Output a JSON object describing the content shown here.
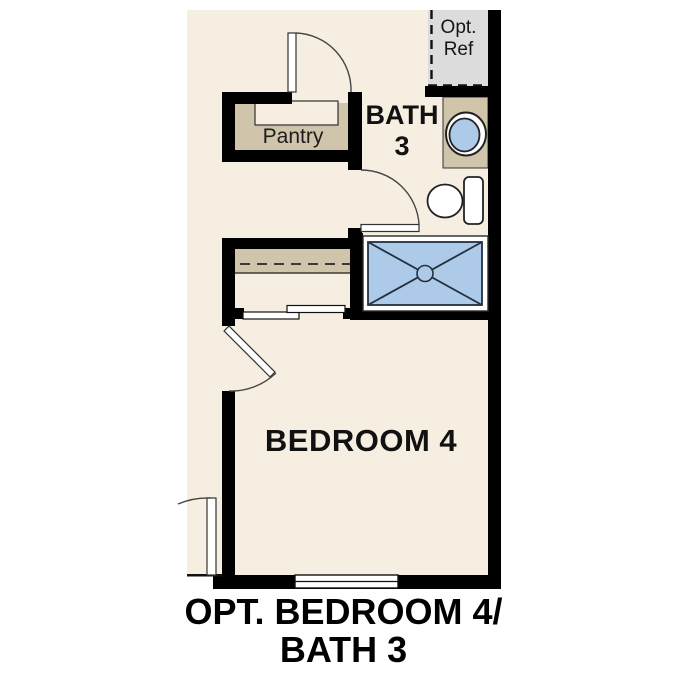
{
  "caption": {
    "line1": "OPT. BEDROOM 4/",
    "line2": "BATH 3"
  },
  "rooms": {
    "pantry": {
      "label": "Pantry"
    },
    "bath": {
      "name_line1": "BATH",
      "name_line2": "3"
    },
    "bedroom": {
      "label": "BEDROOM 4"
    }
  },
  "annotations": {
    "opt_ref": {
      "line1": "Opt.",
      "line2": "Ref"
    }
  },
  "fixtures": [
    "shower-pan",
    "vanity-sink",
    "toilet",
    "pantry-shelf",
    "closet-shelf-rod",
    "sliding-closet-doors",
    "window",
    "swing-doors"
  ],
  "colors": {
    "floor": "#f6eee1",
    "wall": "#000000",
    "shelf_tan": "#d0c5ab",
    "optional_gray": "#dcdcdc",
    "fixture_blue": "#adcae8",
    "line": "#2f2f2f",
    "text": "#111111"
  }
}
